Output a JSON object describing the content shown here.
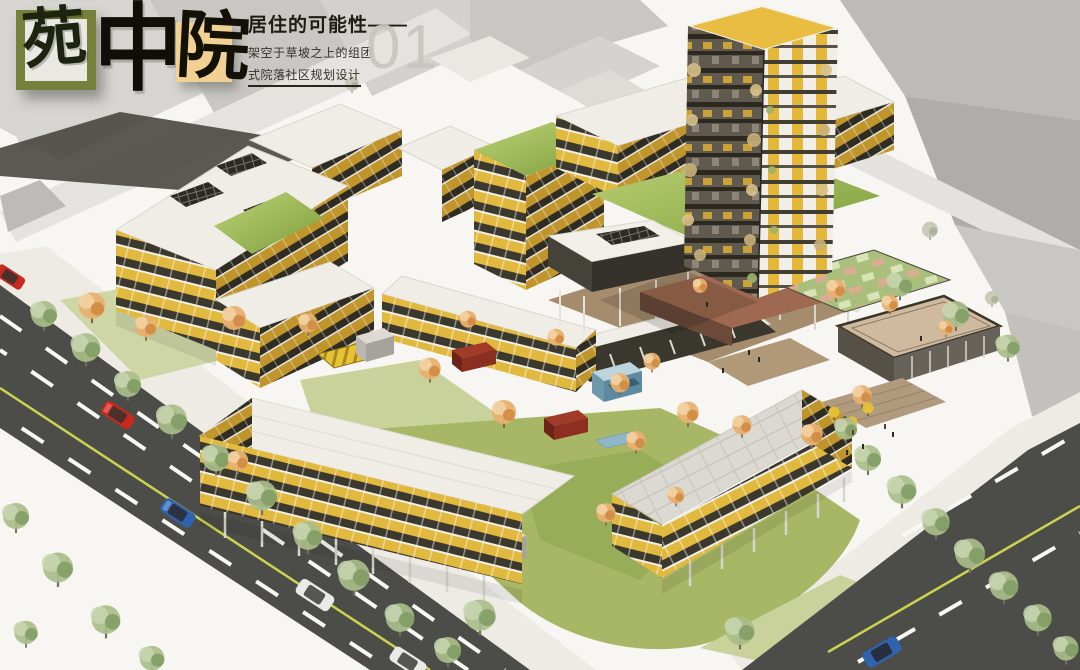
{
  "title_block": {
    "logo": {
      "char1": "苑",
      "char2": "中",
      "char3": "院"
    },
    "heading": "居住的可能性——",
    "subtitle_line1": "架空于草坡之上的组团",
    "subtitle_line2": "式院落社区规划设计",
    "page_number": "01"
  },
  "colors": {
    "logo_box1_border": "#75803a",
    "logo_box2_fill": "#f1d193",
    "ink": "#17150f",
    "page_number_gray": "#c8c6be",
    "facade_yellow": "#e2b93f",
    "facade_dark": "#3b382e",
    "facade_side": "#c0952c",
    "roof_white": "#efede5",
    "grass_light": "#bdd276",
    "grass_dark": "#7d9e3c",
    "lawn_green": "#a7b765",
    "lawn_light": "#c9d29b",
    "tree_green": "#a9bd8a",
    "tree_green_dark": "#7f9c63",
    "tree_autumn": "#e8b070",
    "tree_autumn_dark": "#d08a42",
    "road_asphalt": "#4c4c49",
    "line_yellow": "#ced34f",
    "line_white": "#f7f7f4",
    "context_gray": "#c7c6c2",
    "walk_light": "#edebe4",
    "glass_dark": "#3a372e",
    "podium_terracotta": "#9e6950",
    "court_green": "#abbf7d",
    "deck_tan": "#b19b7f",
    "pool_blue": "#90b7c9",
    "pavilion_red": "#a23a28",
    "car_red": "#c9281f",
    "car_blue": "#2f63b0",
    "car_white": "#eaeae6"
  }
}
